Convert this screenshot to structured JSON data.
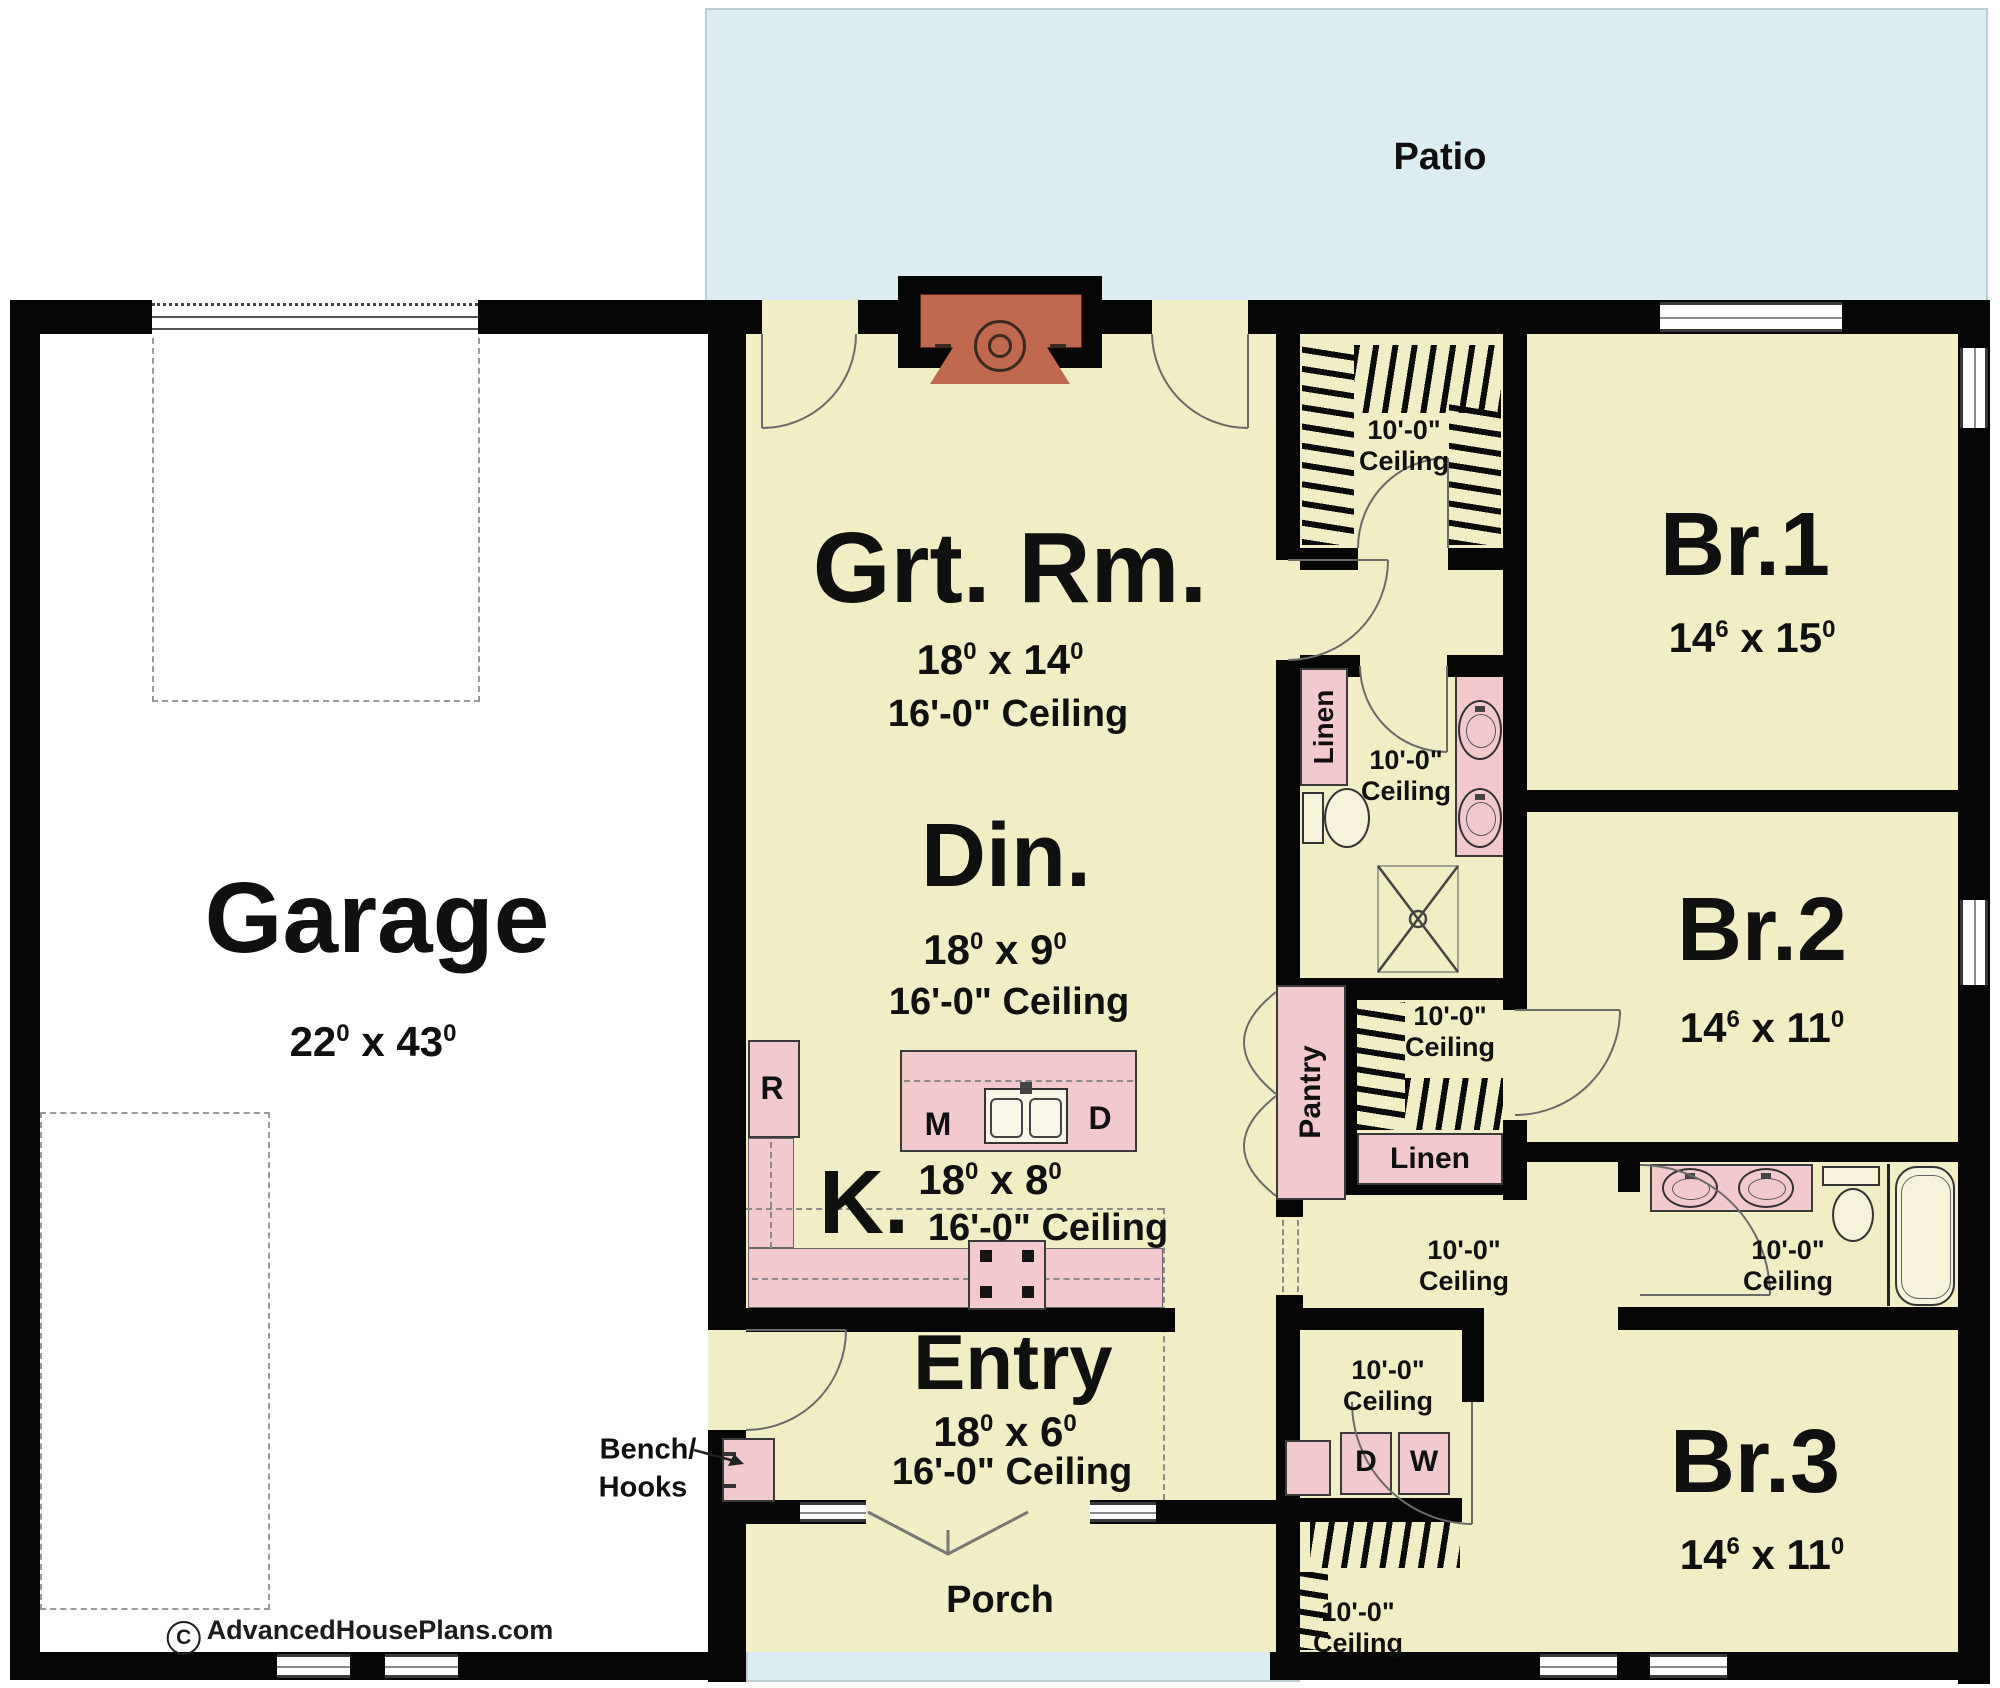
{
  "dim_sep": "x",
  "outdoor": {
    "patio": "Patio",
    "porch": "Porch"
  },
  "rooms": {
    "garage": {
      "label": "Garage",
      "dim": {
        "a": "22",
        "as": "0",
        "b": "43",
        "bs": "0"
      }
    },
    "great_room": {
      "label": "Grt. Rm.",
      "dim": {
        "a": "18",
        "as": "0",
        "b": "14",
        "bs": "0"
      },
      "ceiling": "16'-0\" Ceiling"
    },
    "dining": {
      "label": "Din.",
      "dim": {
        "a": "18",
        "as": "0",
        "b": "9",
        "bs": "0"
      },
      "ceiling": "16'-0\" Ceiling"
    },
    "kitchen": {
      "label": "K.",
      "dim": {
        "a": "18",
        "as": "0",
        "b": "8",
        "bs": "0"
      },
      "ceiling": "16'-0\" Ceiling"
    },
    "entry": {
      "label": "Entry",
      "dim": {
        "a": "18",
        "as": "0",
        "b": "6",
        "bs": "0"
      },
      "ceiling": "16'-0\" Ceiling"
    },
    "br1": {
      "label": "Br.1",
      "dim": {
        "a": "14",
        "as": "6",
        "b": "15",
        "bs": "0"
      }
    },
    "br2": {
      "label": "Br.2",
      "dim": {
        "a": "14",
        "as": "6",
        "b": "11",
        "bs": "0"
      }
    },
    "br3": {
      "label": "Br.3",
      "dim": {
        "a": "14",
        "as": "6",
        "b": "11",
        "bs": "0"
      }
    }
  },
  "ceiling10": {
    "line1": "10'-0\"",
    "line2": "Ceiling"
  },
  "closets": {
    "pantry": "Pantry",
    "linen_bath": "Linen",
    "linen_hall": "Linen"
  },
  "appliances": {
    "fridge": "R",
    "microwave": "M",
    "dishwasher": "D",
    "dryer": "D",
    "washer": "W"
  },
  "annotations": {
    "bench": "Bench/",
    "hooks": "Hooks"
  },
  "branding": {
    "symbol": "C",
    "site": "AdvancedHousePlans.com"
  },
  "colors": {
    "floor": "#f1eec6",
    "outdoor": "#dcedf2",
    "fixture_pink": "#f2cace",
    "fireplace_red": "#c1694f",
    "wall": "#060606"
  }
}
